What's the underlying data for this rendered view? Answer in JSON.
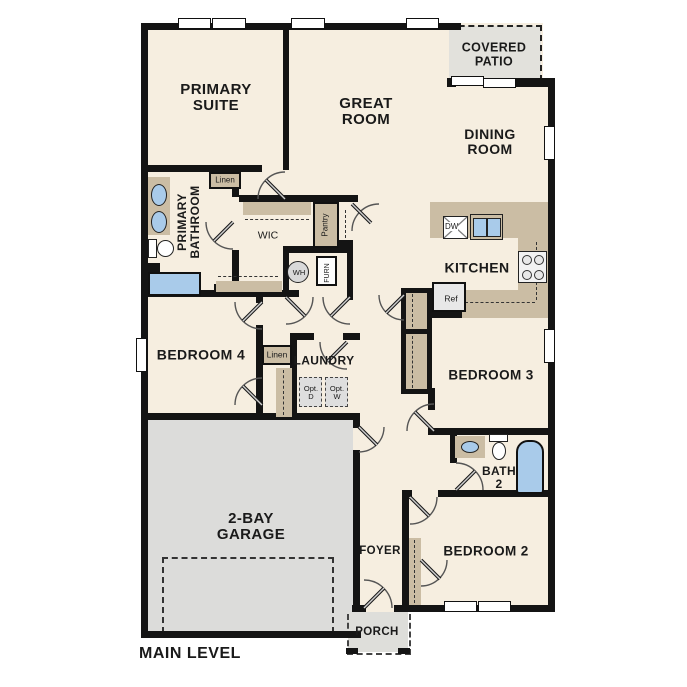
{
  "title": "MAIN LEVEL",
  "colors": {
    "floor": "#f6eee0",
    "wall": "#141414",
    "cabinet": "#cbbda4",
    "garage_gray": "#dcdcda",
    "fixture_blue": "#a9cbea"
  },
  "rooms": {
    "primary_suite": {
      "label": "PRIMARY\nSUITE"
    },
    "great_room": {
      "label": "GREAT\nROOM"
    },
    "covered_patio": {
      "label": "COVERED\nPATIO"
    },
    "dining_room": {
      "label": "DINING\nROOM"
    },
    "kitchen": {
      "label": "KITCHEN"
    },
    "primary_bathroom": {
      "label": "PRIMARY\nBATHROOM"
    },
    "wic": {
      "label": "WIC"
    },
    "pantry": {
      "label": "Pantry"
    },
    "linen_bath": {
      "label": "Linen"
    },
    "linen_hall": {
      "label": "Linen"
    },
    "bedroom_4": {
      "label": "BEDROOM 4"
    },
    "laundry": {
      "label": "LAUNDRY"
    },
    "bedroom_3": {
      "label": "BEDROOM 3"
    },
    "bath_2": {
      "label": "BATH\n2"
    },
    "bedroom_2": {
      "label": "BEDROOM 2"
    },
    "foyer": {
      "label": "FOYER"
    },
    "porch": {
      "label": "PORCH"
    },
    "garage": {
      "label": "2-BAY\nGARAGE"
    }
  },
  "fixtures": {
    "dishwasher": "DW",
    "refrigerator": "Ref",
    "water_heater": "WH",
    "furnace": "FURN",
    "optional_dryer": "Opt.\nD",
    "optional_washer": "Opt.\nW"
  }
}
